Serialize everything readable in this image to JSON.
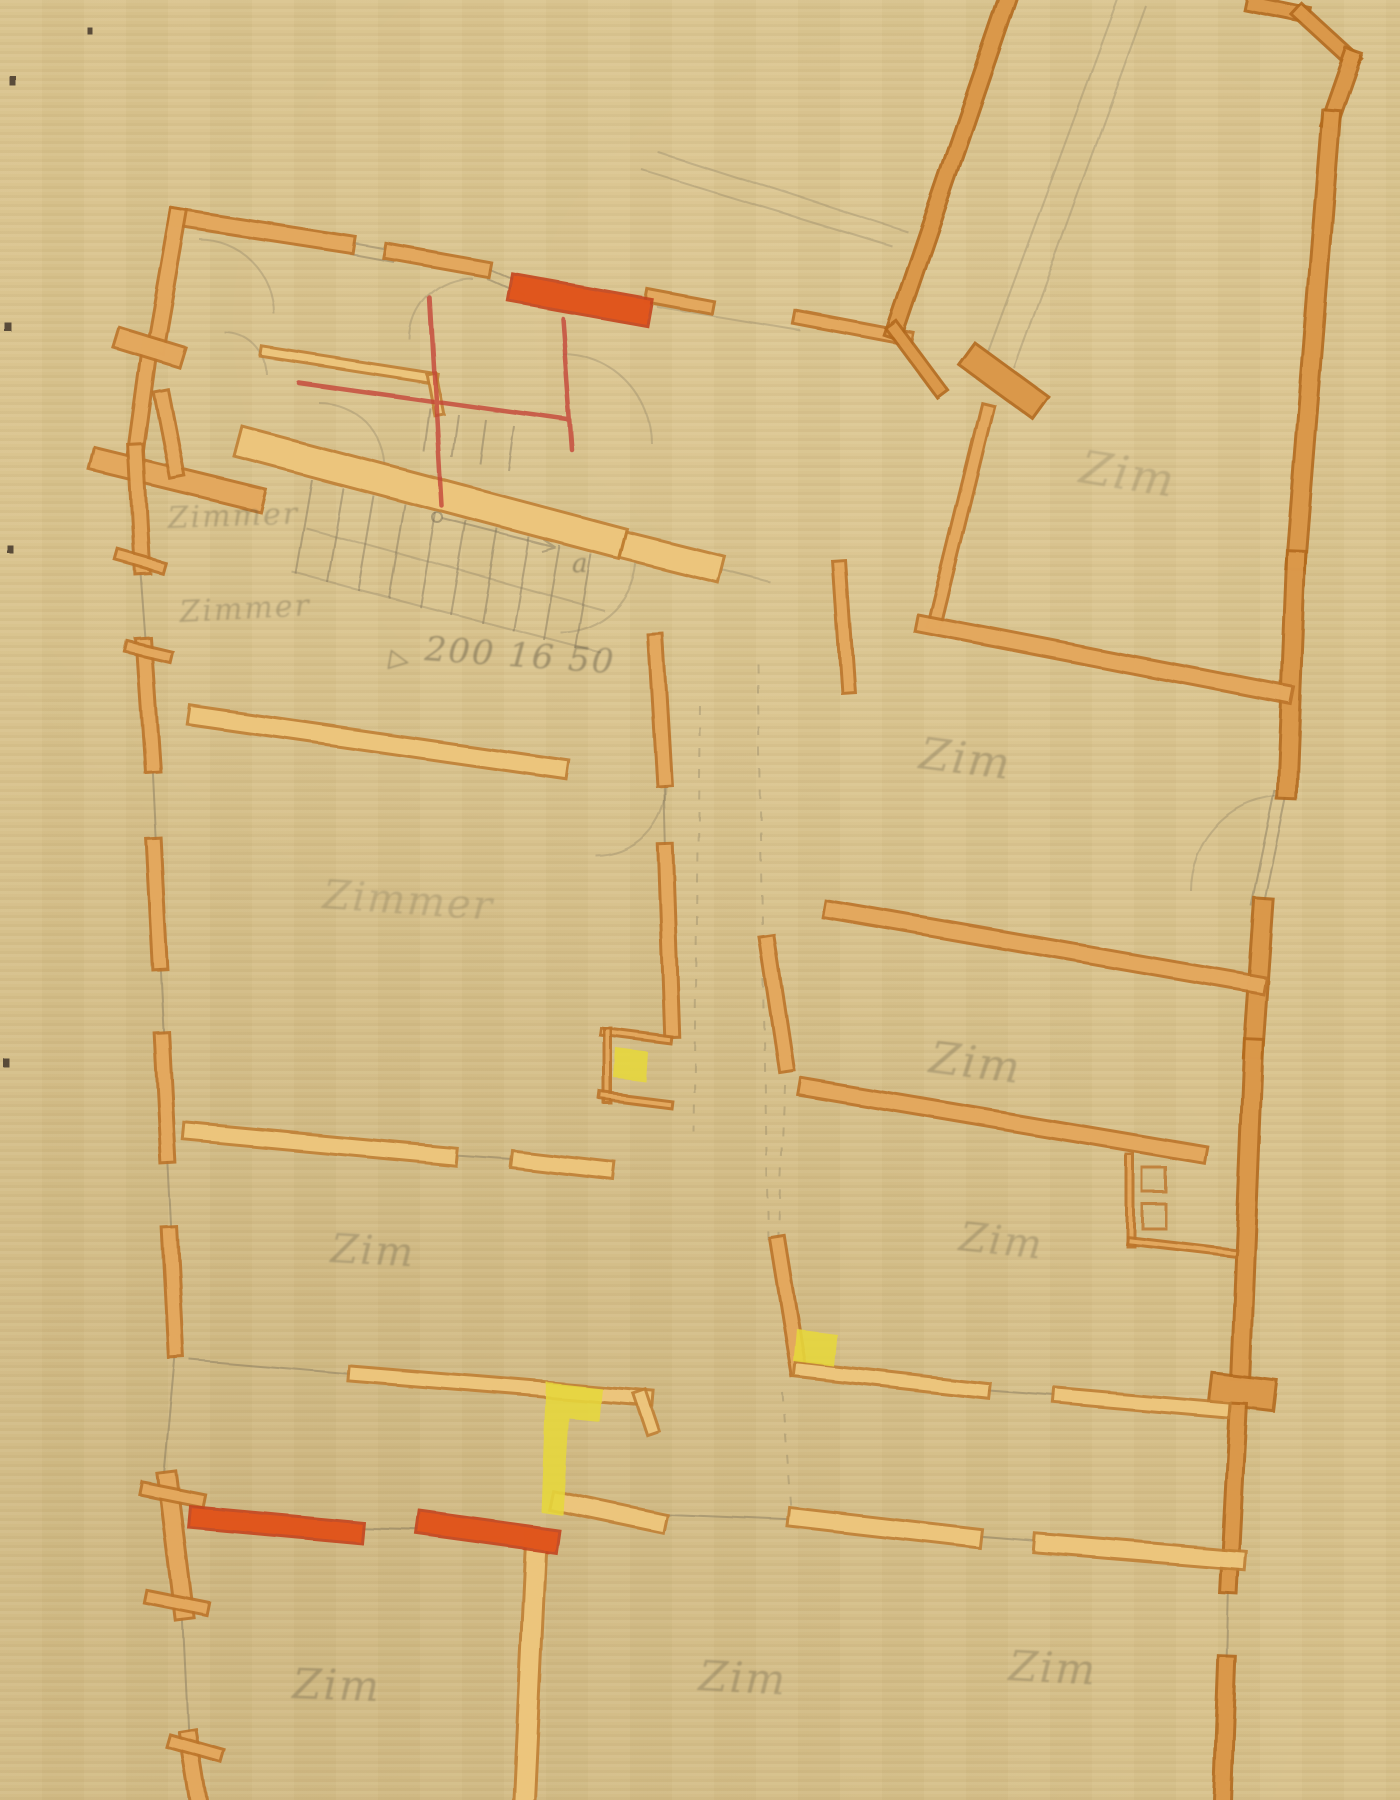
{
  "document": {
    "title": "Hand-drawn architectural floor plan",
    "type": "floor plan sketch (alteration drawing)",
    "medium": "colored pencil and graphite on toned paper"
  },
  "palette": {
    "paper": "#d8c28c",
    "wall_light_fill": "#eec87f",
    "wall_mid_fill": "#e5ab60",
    "wall_deep_fill": "#dc9a4b",
    "wall_edge": "#bb742a",
    "highlight_red": "#e2561d",
    "red_pencil": "#c44438",
    "highlight_yellow": "#e6d73c",
    "graphite": "#6e6450"
  },
  "labels": [
    {
      "text": "Zimmer",
      "role": "room-label-scribble-upper-left-1"
    },
    {
      "text": "Zimmer",
      "role": "room-label-scribble-upper-left-2"
    },
    {
      "text": "Zimmer",
      "role": "room-label-left-middle"
    },
    {
      "text": "Zim",
      "role": "room-label-left-lower"
    },
    {
      "text": "Zim",
      "role": "room-label-bottom-left"
    },
    {
      "text": "Zim",
      "role": "room-label-bottom-middle"
    },
    {
      "text": "Zim",
      "role": "room-label-bottom-right"
    },
    {
      "text": "Zim",
      "role": "room-label-top-right-wing"
    },
    {
      "text": "Zim",
      "role": "room-label-right-1"
    },
    {
      "text": "Zim",
      "role": "room-label-right-2"
    },
    {
      "text": "Zim",
      "role": "room-label-right-3"
    }
  ],
  "dimension_note": {
    "marker": "▷",
    "text": "200 16 50"
  },
  "stair_mark": {
    "text": "a"
  }
}
